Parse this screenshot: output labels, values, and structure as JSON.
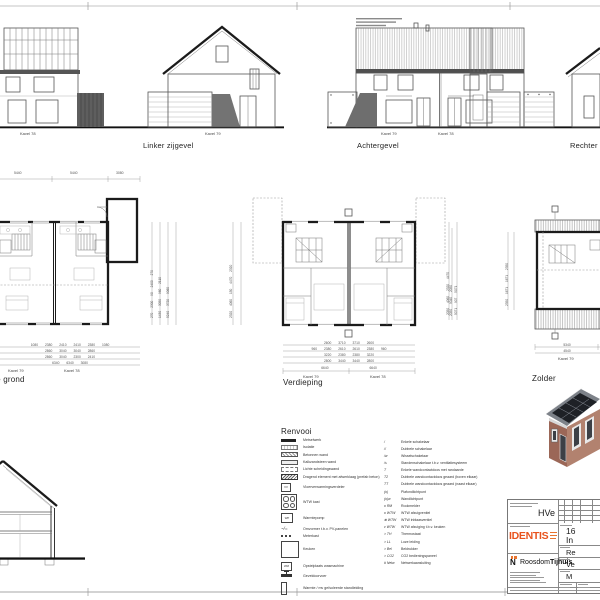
{
  "colors": {
    "accent_orange": "#E8531E",
    "line_dark": "#1b1b1b",
    "roof_gray": "#7d8289",
    "solar_panel": "#1e2126",
    "brick": "#9b6757",
    "brick_light": "#b2826f"
  },
  "elevations": {
    "left_partial": {
      "kavel": "Kavel 78"
    },
    "linker": {
      "title": "Linker zijgevel",
      "kavel": "Kavel 79"
    },
    "achter": {
      "title": "Achtergevel",
      "kavel_left": "Kavel 79",
      "kavel_right": "Kavel 78"
    },
    "rechter": {
      "title": "Rechter zijgevel"
    }
  },
  "plans": {
    "begane_grond": {
      "title": "Begane grond",
      "kavel_left": "Kavel 79",
      "kavel_right": "Kavel 78",
      "dims_top": [
        "5440",
        "5440",
        "3080"
      ],
      "dims_bottom_rows": [
        [
          "1080",
          "2380",
          "2410",
          "2410",
          "2380",
          "1080"
        ],
        [
          "2860",
          "3040",
          "3040",
          "2860"
        ],
        [
          "2860",
          "3040",
          "2300",
          "2410"
        ],
        [
          "6340",
          "6340",
          "3080"
        ]
      ],
      "dims_right_cols": [
        "270 2300 90 2400 270",
        "1430 3050 960 2110",
        "5240 3720 9060"
      ]
    },
    "verdieping": {
      "title": "Verdieping",
      "kavel_left": "Kavel 79",
      "kavel_right": "Kavel 78",
      "dims_bottom_rows": [
        [
          "2600",
          "3710",
          "3710",
          "2600"
        ],
        [
          "960",
          "2380",
          "2610",
          "2610",
          "2380",
          "960"
        ],
        [
          "3220",
          "2380",
          "2380",
          "3220"
        ],
        [
          "2800",
          "3440",
          "3440",
          "2800"
        ],
        [
          "6640",
          "6640"
        ]
      ],
      "dims_left_col": "2320 4060 150 4470 2320",
      "dims_right_col": "2050 9040 2050"
    },
    "zolder": {
      "title": "Zolder",
      "kavel": "Kavel 79",
      "dims_bottom_rows": [
        [
          "5340"
        ],
        [
          "4540"
        ]
      ],
      "dims_left_cols": [
        "2050 4060 2320 4470",
        "5071 907 5071"
      ],
      "dims_inner_col": "2350 1671 1671 2350"
    }
  },
  "legend": {
    "title": "Renvooi",
    "left": [
      {
        "sym": "solid",
        "label": "Metselwerk"
      },
      {
        "sym": "iso",
        "label": "Isolatie"
      },
      {
        "sym": "beton",
        "label": "Betonnen wand"
      },
      {
        "sym": "kzs",
        "label": "Kalkzandsteen wand"
      },
      {
        "sym": "licht",
        "label": "Lichte scheidingswand"
      },
      {
        "sym": "dragend",
        "label": "Dragend element met afwerklaag (prefab beton)"
      },
      {
        "sym": "box",
        "abbr": "VV",
        "label": "Vloerverwarmingsverdeler"
      },
      {
        "sym": "wtw",
        "label": "WTW kast"
      },
      {
        "sym": "box",
        "abbr": "WP",
        "label": "Warmtepomp"
      },
      {
        "sym": "pv",
        "abbr": "~/=",
        "label": "Omvormer t.b.v. PV-panelen"
      },
      {
        "sym": "mk",
        "label": "Meterkast"
      },
      {
        "sym": "keuken",
        "label": "Keuken"
      },
      {
        "sym": "box",
        "abbr": "WM",
        "label": "Opstelplaats wasmachine"
      },
      {
        "sym": "gdv",
        "label": "Geveldoorvoer"
      },
      {
        "sym": "stand",
        "label": "Warmte / mv geïsoleerde standleiding"
      }
    ],
    "right": [
      {
        "sym": "/",
        "label": "Enkele schakelaar"
      },
      {
        "sym": "//",
        "label": "Dubbele schakelaar"
      },
      {
        "sym": "/w",
        "label": "Wisselschakelaar"
      },
      {
        "sym": "/s",
        "label": "Standenschakelaar t.b.v. ventilatiesysteem"
      },
      {
        "sym": "T",
        "label": "Enkele wandcontactdoos met randaarde"
      },
      {
        "sym": "T2",
        "label": "Dubbele wandcontactdoos geaard (boven elkaar)"
      },
      {
        "sym": "TT",
        "label": "Dubbele wandcontactdoos geaard (naast elkaar)"
      },
      {
        "sym": "(o)",
        "label": "Plafondlichtpunt"
      },
      {
        "sym": "(o)w",
        "label": "Wandlichtpunt"
      },
      {
        "sym": "o RM",
        "label": "Rookmelder"
      },
      {
        "sym": "o WTW",
        "label": "WTW afzuigventiel"
      },
      {
        "sym": "⊕ WTW",
        "label": "WTW inblaasventiel"
      },
      {
        "sym": "v WTW",
        "label": "WTW afzuiging t.b.v. keuken"
      },
      {
        "sym": "> TH",
        "label": "Thermostaat"
      },
      {
        "sym": "> LL",
        "label": "Loze leiding"
      },
      {
        "sym": "> Bel",
        "label": "Beldrukker"
      },
      {
        "sym": "> CO2",
        "label": "CO2 bedieningspaneel"
      },
      {
        "sym": "# Netw",
        "label": "Netwerkaansluiting"
      }
    ]
  },
  "titleblock": {
    "sheet_code": "HVe",
    "identis_logo": "IDENTIS",
    "roosdom_logo_regular": "Roosdom",
    "roosdom_logo_bold": "Tijhuis",
    "cells": {
      "c1": "16",
      "c2": "In",
      "c3": "Re",
      "c4": "Ve",
      "c5": "M"
    }
  }
}
